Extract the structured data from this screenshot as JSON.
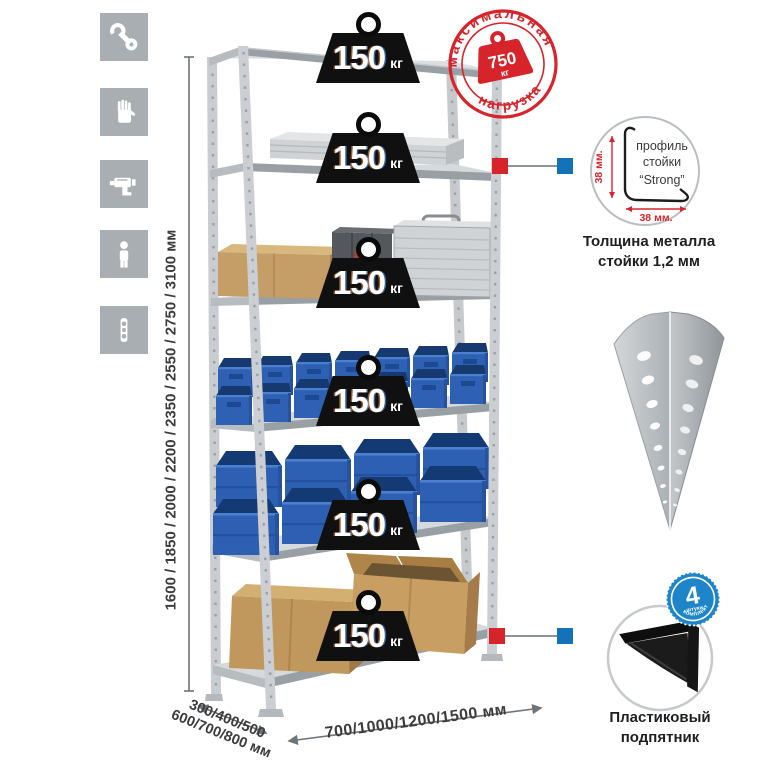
{
  "sidebar": {
    "tiles": [
      {
        "icon": "wrench"
      },
      {
        "icon": "gloves"
      },
      {
        "icon": "drill"
      },
      {
        "icon": "person"
      },
      {
        "icon": "level"
      }
    ]
  },
  "rack": {
    "load": {
      "value": "150",
      "unit": "кг"
    }
  },
  "stamp": {
    "arc_top": "максимальная",
    "arc_bottom": "нагрузка",
    "value": "750",
    "unit": "кг"
  },
  "dims": {
    "height": "1600 / 1850 / 2000 / 2200 / 2350 / 2550 / 2750 / 3100 мм",
    "depth1": "300/400/500",
    "depth2": "600/700/800 мм",
    "width": "700/1000/1200/1500 мм"
  },
  "profile": {
    "l1": "профиль",
    "l2": "стойки",
    "l3": "“Strong”",
    "dim_v": "38 мм.",
    "dim_h": "38 мм.",
    "cap1": "Толщина металла",
    "cap2": "стойки 1,2 мм"
  },
  "foot": {
    "badge": "4",
    "badge_sub": "штуки",
    "badge_arc": "в комплекте",
    "cap1": "Пластиковый",
    "cap2": "подпятник"
  },
  "colors": {
    "accent_red": "#d7242b",
    "accent_blue": "#1472b8",
    "bin_blue": "#2e61b4",
    "tile_gray": "#a9aeb3"
  }
}
